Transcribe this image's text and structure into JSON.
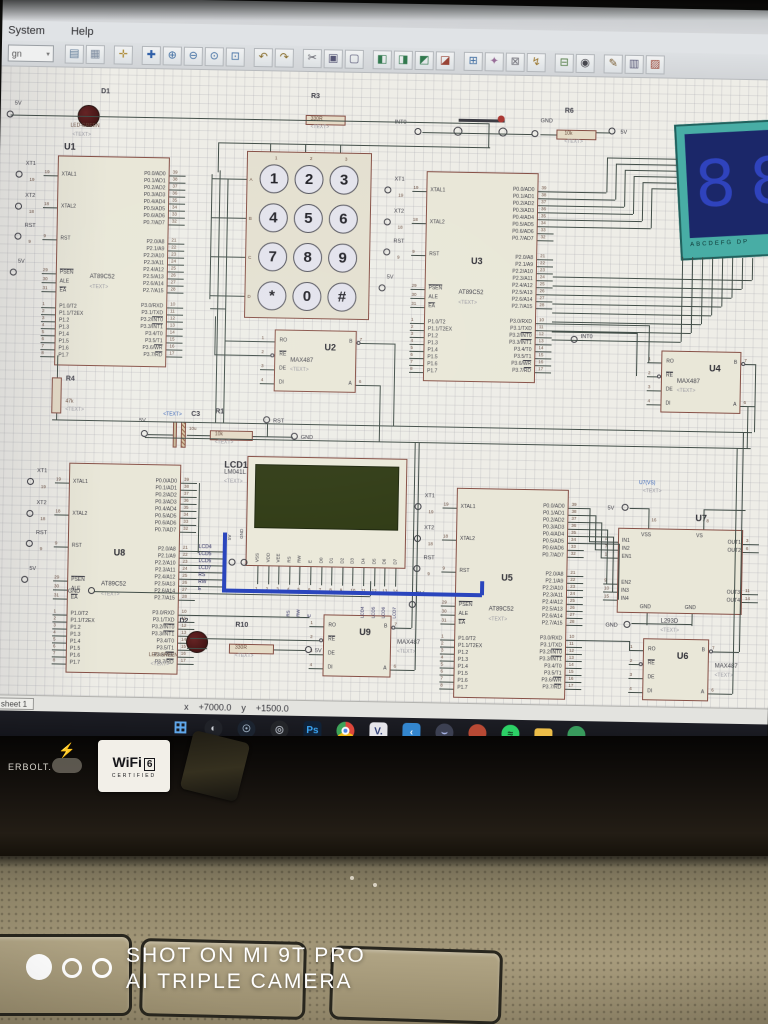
{
  "app": {
    "menu_items": [
      "System",
      "Help"
    ],
    "toolbar_combo": "gn",
    "toolbar_icons": [
      {
        "name": "sheet",
        "g": "▤",
        "c": "#5a7a9a"
      },
      {
        "name": "grid-toggle",
        "g": "▦",
        "c": "#7a8aa0"
      },
      {
        "name": "origin",
        "g": "✛",
        "c": "#b08828"
      },
      {
        "name": "pan",
        "g": "✚",
        "c": "#2a5fb0"
      },
      {
        "name": "zoom-in",
        "g": "⊕",
        "c": "#3a6ea8"
      },
      {
        "name": "zoom-out",
        "g": "⊖",
        "c": "#3a6ea8"
      },
      {
        "name": "zoom-all",
        "g": "⊙",
        "c": "#3a6ea8"
      },
      {
        "name": "zoom-area",
        "g": "⊡",
        "c": "#3a6ea8"
      },
      {
        "name": "undo",
        "g": "↶",
        "c": "#8a6a20"
      },
      {
        "name": "redo",
        "g": "↷",
        "c": "#8a6a20"
      },
      {
        "name": "cut",
        "g": "✂",
        "c": "#555560"
      },
      {
        "name": "copy",
        "g": "▣",
        "c": "#555577"
      },
      {
        "name": "paste",
        "g": "▢",
        "c": "#555577"
      },
      {
        "name": "block-copy",
        "g": "◧",
        "c": "#2a7a4a"
      },
      {
        "name": "block-move",
        "g": "◨",
        "c": "#2a7a4a"
      },
      {
        "name": "block-rotate",
        "g": "◩",
        "c": "#2a7a4a"
      },
      {
        "name": "block-delete",
        "g": "◪",
        "c": "#a04030"
      },
      {
        "name": "pick-part",
        "g": "⊞",
        "c": "#3a6ea8"
      },
      {
        "name": "make-device",
        "g": "✦",
        "c": "#9a6a9a"
      },
      {
        "name": "packaging",
        "g": "⊠",
        "c": "#70707a"
      },
      {
        "name": "decompose",
        "g": "↯",
        "c": "#a07828"
      },
      {
        "name": "wire-autorouter",
        "g": "⊟",
        "c": "#4a7a3a"
      },
      {
        "name": "search-tag",
        "g": "◉",
        "c": "#44444c"
      },
      {
        "name": "property-assign",
        "g": "✎",
        "c": "#7a5a2a"
      },
      {
        "name": "new-sheet",
        "g": "▥",
        "c": "#555577"
      },
      {
        "name": "remove-sheet",
        "g": "▨",
        "c": "#a04030"
      }
    ],
    "status": {
      "tab": "sheet 1",
      "x_label": "x",
      "x_value": "+7000.0",
      "y_label": "y",
      "y_value": "+1500.0"
    },
    "taskbar_icons": [
      {
        "name": "windows-start",
        "kind": "glyph",
        "g": "⊞",
        "fg": "#5aaaf5",
        "bg": ""
      },
      {
        "name": "app-swirl",
        "kind": "disc",
        "g": "◐",
        "fg": "#cfd4da",
        "bg": "#1d1f26"
      },
      {
        "name": "steam",
        "kind": "disc",
        "g": "☉",
        "fg": "#9fb4c8",
        "bg": "#17202e"
      },
      {
        "name": "app-target",
        "kind": "disc",
        "g": "◎",
        "fg": "#aab0bb",
        "bg": "#202227"
      },
      {
        "name": "photoshop",
        "kind": "square",
        "g": "Ps",
        "fg": "#31a8ff",
        "bg": "#0a1f38"
      },
      {
        "name": "chrome",
        "kind": "chrome",
        "g": "",
        "fg": "",
        "bg": ""
      },
      {
        "name": "vmware",
        "kind": "square",
        "g": "V.",
        "fg": "#2a3b7a",
        "bg": "#e8e8ee"
      },
      {
        "name": "vscode",
        "kind": "square",
        "g": "‹",
        "fg": "#eaf4fb",
        "bg": "#2a87d8"
      },
      {
        "name": "discord",
        "kind": "disc",
        "g": "⌣",
        "fg": "#aab8f0",
        "bg": "#3a3e52"
      },
      {
        "name": "music-app",
        "kind": "disc",
        "g": "",
        "fg": "#fff",
        "bg": "#c2452e"
      },
      {
        "name": "spotify",
        "kind": "disc",
        "g": "≈",
        "fg": "#0b3018",
        "bg": "#1ed760"
      },
      {
        "name": "file-explorer",
        "kind": "folder",
        "g": "",
        "fg": "",
        "bg": "#f3bf3c"
      },
      {
        "name": "app-green",
        "kind": "disc",
        "g": "",
        "fg": "#fff",
        "bg": "#2f9d58"
      }
    ]
  },
  "schematic": {
    "text_placeholder": "<TEXT>",
    "mcu_part": "AT89C52",
    "mcu_pins": {
      "left_top": [
        [
          "XTAL1",
          "19",
          0
        ],
        [
          "XTAL2",
          "18",
          0
        ],
        [
          "RST",
          "9",
          0
        ]
      ],
      "left_mid": [
        [
          "PSEN",
          "29",
          1
        ],
        [
          "ALE",
          "30",
          0
        ],
        [
          "EA",
          "31",
          1
        ]
      ],
      "left_bot": [
        [
          "P1.0/T2",
          "1",
          0
        ],
        [
          "P1.1/T2EX",
          "2",
          0
        ],
        [
          "P1.2",
          "3",
          0
        ],
        [
          "P1.3",
          "4",
          0
        ],
        [
          "P1.4",
          "5",
          0
        ],
        [
          "P1.5",
          "6",
          0
        ],
        [
          "P1.6",
          "7",
          0
        ],
        [
          "P1.7",
          "8",
          0
        ]
      ],
      "right_top": [
        [
          "P0.0/AD0",
          "39",
          0
        ],
        [
          "P0.1/AD1",
          "38",
          0
        ],
        [
          "P0.2/AD2",
          "37",
          0
        ],
        [
          "P0.3/AD3",
          "36",
          0
        ],
        [
          "P0.4/AD4",
          "35",
          0
        ],
        [
          "P0.5/AD5",
          "34",
          0
        ],
        [
          "P0.6/AD6",
          "33",
          0
        ],
        [
          "P0.7/AD7",
          "32",
          0
        ]
      ],
      "right_mid": [
        [
          "P2.0/A8",
          "21",
          0
        ],
        [
          "P2.1/A9",
          "22",
          0
        ],
        [
          "P2.2/A10",
          "23",
          0
        ],
        [
          "P2.3/A11",
          "24",
          0
        ],
        [
          "P2.4/A12",
          "25",
          0
        ],
        [
          "P2.5/A13",
          "26",
          0
        ],
        [
          "P2.6/A14",
          "27",
          0
        ],
        [
          "P2.7/A15",
          "28",
          0
        ]
      ],
      "right_bot": [
        [
          "P3.0/RXD",
          "10",
          0
        ],
        [
          "P3.1/TXD",
          "11",
          0
        ],
        [
          "P3.2/INT0",
          "12",
          2
        ],
        [
          "P3.3/INT1",
          "13",
          2
        ],
        [
          "P3.4/T0",
          "14",
          0
        ],
        [
          "P3.5/T1",
          "15",
          0
        ],
        [
          "P3.6/WR",
          "16",
          2
        ],
        [
          "P3.7/RD",
          "17",
          2
        ]
      ]
    },
    "mcus": [
      {
        "ref": "U1"
      },
      {
        "ref": "U3"
      },
      {
        "ref": "U8"
      },
      {
        "ref": "U5"
      }
    ],
    "max487_part": "MAX487",
    "max487_pins": {
      "left": [
        [
          "RO",
          "1",
          0
        ],
        [
          "RE",
          "2",
          1
        ],
        [
          "DE",
          "3",
          0
        ],
        [
          "DI",
          "4",
          0
        ]
      ],
      "right": [
        [
          "B",
          "7",
          0
        ],
        [
          "A",
          "6",
          0
        ]
      ]
    },
    "max487s": [
      {
        "ref": "U2"
      },
      {
        "ref": "U4"
      },
      {
        "ref": "U9"
      },
      {
        "ref": "U6"
      }
    ],
    "l293d": {
      "ref": "U7",
      "part": "L293D",
      "vs_label": "U7(VS)",
      "pins_left": [
        [
          "IN1",
          "2"
        ],
        [
          "IN2",
          "7"
        ],
        [
          "EN1",
          "1"
        ],
        [
          "EN2",
          "9"
        ],
        [
          "IN3",
          "10"
        ],
        [
          "IN4",
          "15"
        ]
      ],
      "pins_right": [
        [
          "OUT1",
          "3"
        ],
        [
          "OUT2",
          "6"
        ],
        [
          "OUT3",
          "11"
        ],
        [
          "OUT4",
          "14"
        ]
      ],
      "pins_top": [
        [
          "VSS",
          "16"
        ],
        [
          "VS",
          "8"
        ]
      ],
      "pins_bottom": [
        "GND",
        "GND"
      ]
    },
    "keypad": {
      "keys": [
        [
          "1",
          "2",
          "3"
        ],
        [
          "4",
          "5",
          "6"
        ],
        [
          "7",
          "8",
          "9"
        ],
        [
          "*",
          "0",
          "#"
        ]
      ],
      "row_labels": [
        "A",
        "B",
        "C",
        "D"
      ],
      "col_labels": [
        "1",
        "2",
        "3"
      ]
    },
    "lcd": {
      "ref": "LCD1",
      "part": "LM041L",
      "pins": [
        "VSS",
        "VDD",
        "VEE",
        "RS",
        "RW",
        "E",
        "D0",
        "D1",
        "D2",
        "D3",
        "D4",
        "D5",
        "D6",
        "D7"
      ],
      "pin_numbers": [
        "1",
        "2",
        "3",
        "4",
        "5",
        "6",
        "7",
        "8",
        "9",
        "10",
        "11",
        "12",
        "13",
        "14"
      ],
      "net_labels": [
        "RS",
        "RW",
        "E",
        "LCD4",
        "LCD5",
        "LCD6",
        "LCD7"
      ],
      "top_terminals": [
        "5V",
        "GND"
      ]
    },
    "sevenseg": {
      "label": "ABCDEFG DP",
      "digits": "88"
    },
    "resistors": [
      {
        "ref": "R3",
        "value": "330R"
      },
      {
        "ref": "R6",
        "value": "10k"
      },
      {
        "ref": "R4",
        "value": "47k"
      },
      {
        "ref": "R1",
        "value": "10k"
      },
      {
        "ref": "R10",
        "value": "330R"
      }
    ],
    "capacitors": [
      {
        "ref": "C3",
        "value": "10u"
      }
    ],
    "leds": [
      {
        "ref": "D1",
        "part": "LED-GREEN"
      },
      {
        "ref": "D2",
        "part": "LED-GREEN"
      }
    ],
    "net_labels_u8": [
      "LCD4",
      "LCD5",
      "LCD6",
      "LCD7",
      "RS",
      "RW",
      "E"
    ],
    "terminals": [
      {
        "label": "5V"
      },
      {
        "label": "XT1",
        "pin": "19"
      },
      {
        "label": "XT2",
        "pin": "18"
      },
      {
        "label": "RST",
        "pin": "9"
      },
      {
        "label": "5V"
      },
      {
        "label": "INT0"
      },
      {
        "label": "GND"
      },
      {
        "label": "5V"
      },
      {
        "label": "XT1",
        "pin": "19"
      },
      {
        "label": "XT2",
        "pin": "18"
      },
      {
        "label": "RST",
        "pin": "9"
      },
      {
        "label": "5V"
      },
      {
        "label": "INT0"
      },
      {
        "label": "5V"
      },
      {
        "label": "RST"
      },
      {
        "label": "GND"
      },
      {
        "label": "XT1",
        "pin": "19"
      },
      {
        "label": "XT2",
        "pin": "18"
      },
      {
        "label": "RST",
        "pin": "9"
      },
      {
        "label": "5V"
      },
      {
        "label": "GND"
      },
      {
        "label": "5V"
      },
      {
        "label": "XT1",
        "pin": "19"
      },
      {
        "label": "XT2",
        "pin": "18"
      },
      {
        "label": "RST",
        "pin": "9"
      },
      {
        "label": "5V"
      },
      {
        "label": "5V"
      },
      {
        "label": "GND"
      }
    ]
  },
  "watermark": {
    "line1": "SHOT ON MI 9T PRO",
    "line2": "AI TRIPLE CAMERA"
  },
  "stickers": {
    "thunderbolt_text": "ERBOLT.",
    "bolt": "⚡",
    "wifi_brand": "WiFi",
    "wifi_num": "6",
    "wifi_sub": "CERTIFIED"
  }
}
